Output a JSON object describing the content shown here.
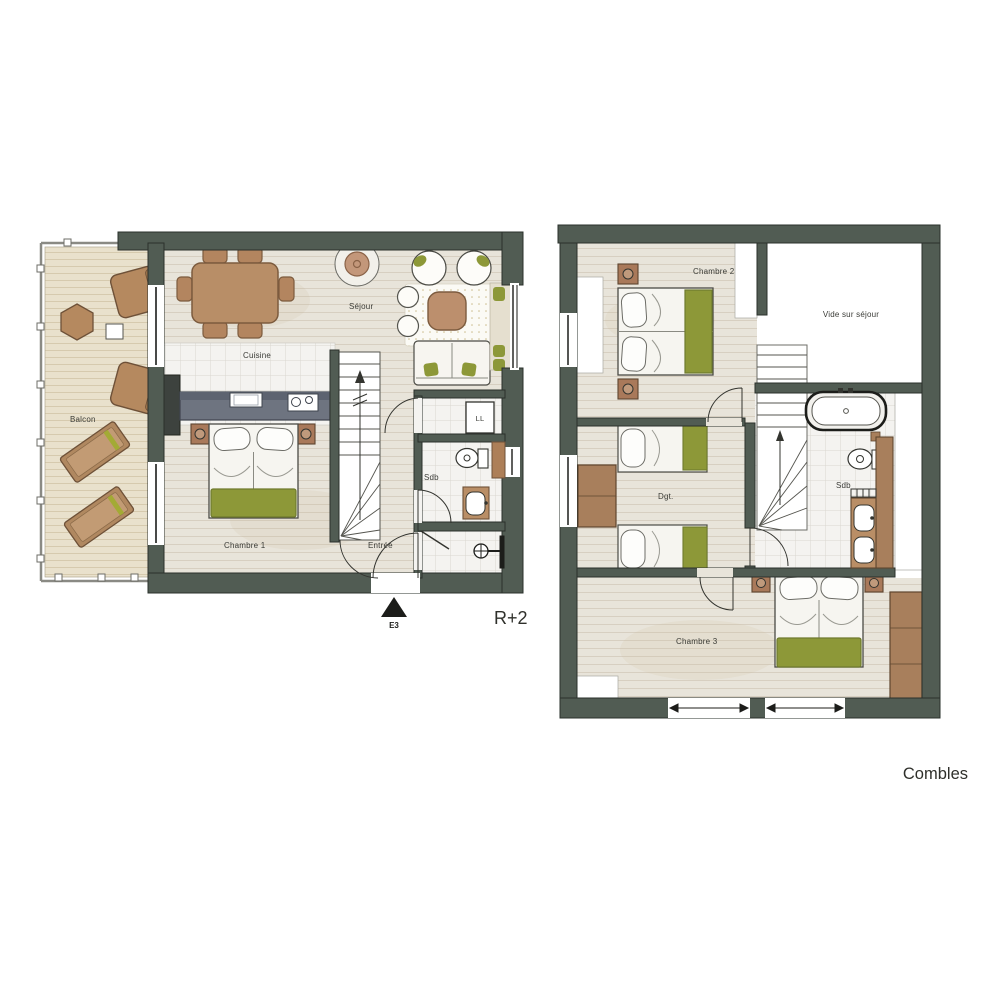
{
  "page": {
    "background": "#ffffff"
  },
  "colors": {
    "wall": "#515c53",
    "wall_edge": "#2a302b",
    "wood_floor": "#e8e4da",
    "wood_line": "#d7cfc1",
    "deck": "#e9e1cc",
    "deck_line": "#d6caae",
    "tile": "#f4f3f0",
    "tile_line": "#dad7d0",
    "furniture_brown": "#b78e67",
    "furniture_brown_dark": "#6e5138",
    "accent_green": "#8d9838",
    "counter_gray": "#6e7480",
    "bed_white": "#f6f5f0",
    "label_text": "#3a3b36"
  },
  "plan_r2": {
    "level_label": "R+2",
    "entrance_marker": "E3",
    "rooms": {
      "balcon": "Balcon",
      "sejour": "Séjour",
      "cuisine": "Cuisine",
      "chambre1": "Chambre 1",
      "entree": "Entrée",
      "sdb": "Sdb",
      "ll": "LL"
    }
  },
  "plan_combles": {
    "level_label": "Combles",
    "rooms": {
      "chambre2": "Chambre 2",
      "vide": "Vide sur séjour",
      "dgt": "Dgt.",
      "sdb": "Sdb",
      "chambre3": "Chambre 3"
    }
  }
}
